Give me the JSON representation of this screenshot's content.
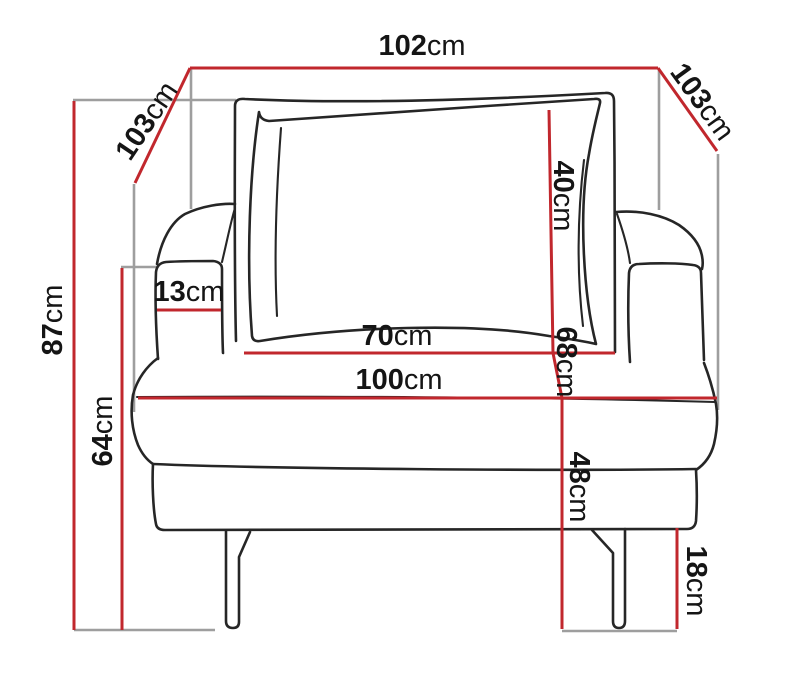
{
  "diagram_type": "furniture-armchair-dimension-drawing",
  "dimensions": {
    "overall_width_top": {
      "value": "102",
      "unit": "cm"
    },
    "diagonal_left": {
      "value": "103",
      "unit": "cm"
    },
    "diagonal_right": {
      "value": "103",
      "unit": "cm"
    },
    "overall_height": {
      "value": "87",
      "unit": "cm"
    },
    "armrest_height": {
      "value": "64",
      "unit": "cm"
    },
    "armrest_width": {
      "value": "13",
      "unit": "cm"
    },
    "backrest_cushion_height": {
      "value": "40",
      "unit": "cm"
    },
    "inner_seat_width": {
      "value": "70",
      "unit": "cm"
    },
    "seat_overall_width": {
      "value": "100",
      "unit": "cm"
    },
    "backrest_height": {
      "value": "68",
      "unit": "cm"
    },
    "seat_height": {
      "value": "48",
      "unit": "cm"
    },
    "leg_height": {
      "value": "18",
      "unit": "cm"
    }
  },
  "colors": {
    "dimension": "#c1272d",
    "reference": "#9e9e9e",
    "outline": "#262626",
    "text": "#151515",
    "background": "#ffffff"
  }
}
